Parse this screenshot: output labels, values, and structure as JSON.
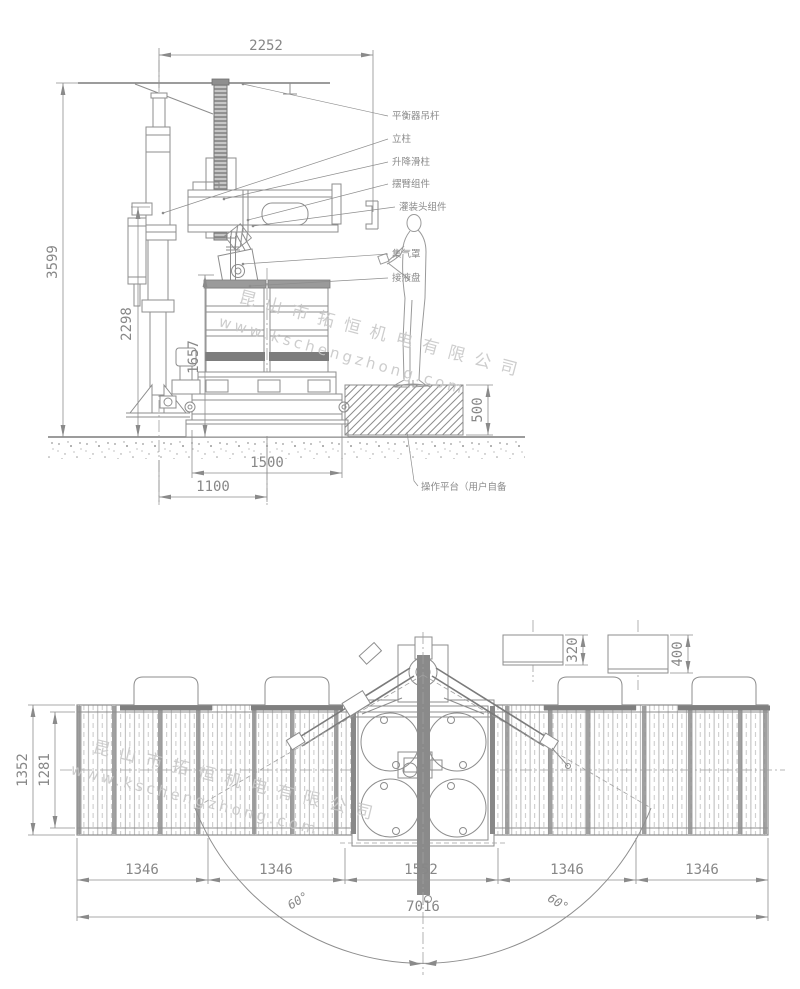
{
  "front_view": {
    "dim_top_width": "2252",
    "dim_total_height": "3599",
    "dim_column_height": "2298",
    "dim_lift_height": "1657",
    "dim_base_length": "1500",
    "dim_center_offset": "1100",
    "dim_platform_height": "500",
    "label_balancer_rod": "平衡器吊杆",
    "label_column": "立柱",
    "label_lift_slide": "升降滑柱",
    "label_swing_arm": "摆臂组件",
    "label_filling_head": "灌装头组件",
    "label_gas_hood": "集气罩",
    "label_drip_tray": "接液盘",
    "label_platform": "操作平台（用户自备"
  },
  "plan_view": {
    "dim_conveyor_width": "1352",
    "dim_roller_width": "1281",
    "dim_sections": [
      "1346",
      "1346",
      "1552",
      "1346",
      "1346"
    ],
    "dim_total_length": "7016",
    "dim_swing_angle_left": "60°",
    "dim_swing_angle_right": "60°",
    "dim_detail_left": "320",
    "dim_detail_right": "400"
  },
  "watermark": {
    "company": "昆山市拓恒机电有限公司",
    "url": "www.kschengzhong.com"
  }
}
